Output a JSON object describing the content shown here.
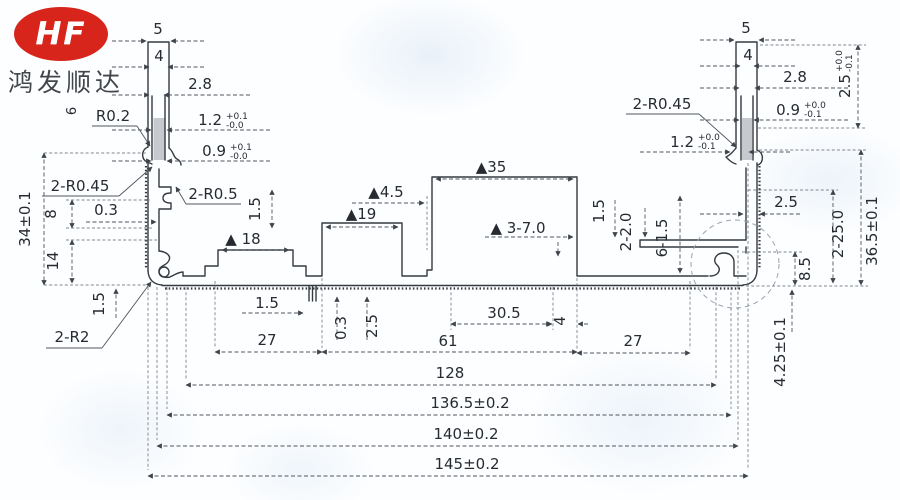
{
  "logo": {
    "brand": "HF",
    "company": "鸿发顺达"
  },
  "colors": {
    "accent_red": "#d8251c",
    "ink": "#262b31",
    "profile_line": "#343a40",
    "dim_line": "#4e555c"
  },
  "labels": {
    "fin5_l": "5",
    "fin4_l": "4",
    "fin28_l": "2.8",
    "r02": "R0.2",
    "slot12_l": "1.2",
    "slot12_l_plus": "+0.1",
    "slot12_l_minus": "-0.0",
    "slot09_l": "0.9",
    "slot09_l_plus": "+0.1",
    "slot09_l_minus": "-0.0",
    "r045_l": "2-R0.45",
    "r05_l": "2-R0.5",
    "height34": "34±0.1",
    "h8": "8",
    "h14": "14",
    "w03_l": "0.3",
    "h15_left_pad": "1.5",
    "h15_bottom_left": "1.5",
    "r2": "2-R2",
    "partial6": "6",
    "pad18": "▲ 18",
    "pad19": "▲19",
    "gap45": "▲4.5",
    "pad35": "▲35",
    "slots7": "▲ 3-7.0",
    "w15_center": "1.5",
    "h03_center": "0.3",
    "h25_center": "2.5",
    "w305": "30.5",
    "w4": "4",
    "w61": "61",
    "w27_left": "27",
    "w27_right": "27",
    "w128": "128",
    "w1365": "136.5±0.2",
    "w140": "140±0.2",
    "w145": "145±0.2",
    "fin5_r": "5",
    "fin4_r": "4",
    "fin28_r": "2.8",
    "slot09_r": "0.9",
    "slot09_r_plus": "+0.0",
    "slot09_r_minus": "-0.1",
    "r045_r": "2-R0.45",
    "slot12_r": "1.2",
    "slot12_r_plus": "+0.0",
    "slot12_r_minus": "-0.1",
    "h25_top_r": "2.5",
    "h25_top_r_plus": "+0.0",
    "h25_top_r_minus": "-0.1",
    "h15_r": "1.5",
    "d2_20": "2-2.0",
    "d6_15": "6-1.5",
    "w25_r": "2.5",
    "d2_250": "2-25.0",
    "height365": "36.5±0.1",
    "h85": "8.5",
    "h425": "4.25±0.1"
  }
}
